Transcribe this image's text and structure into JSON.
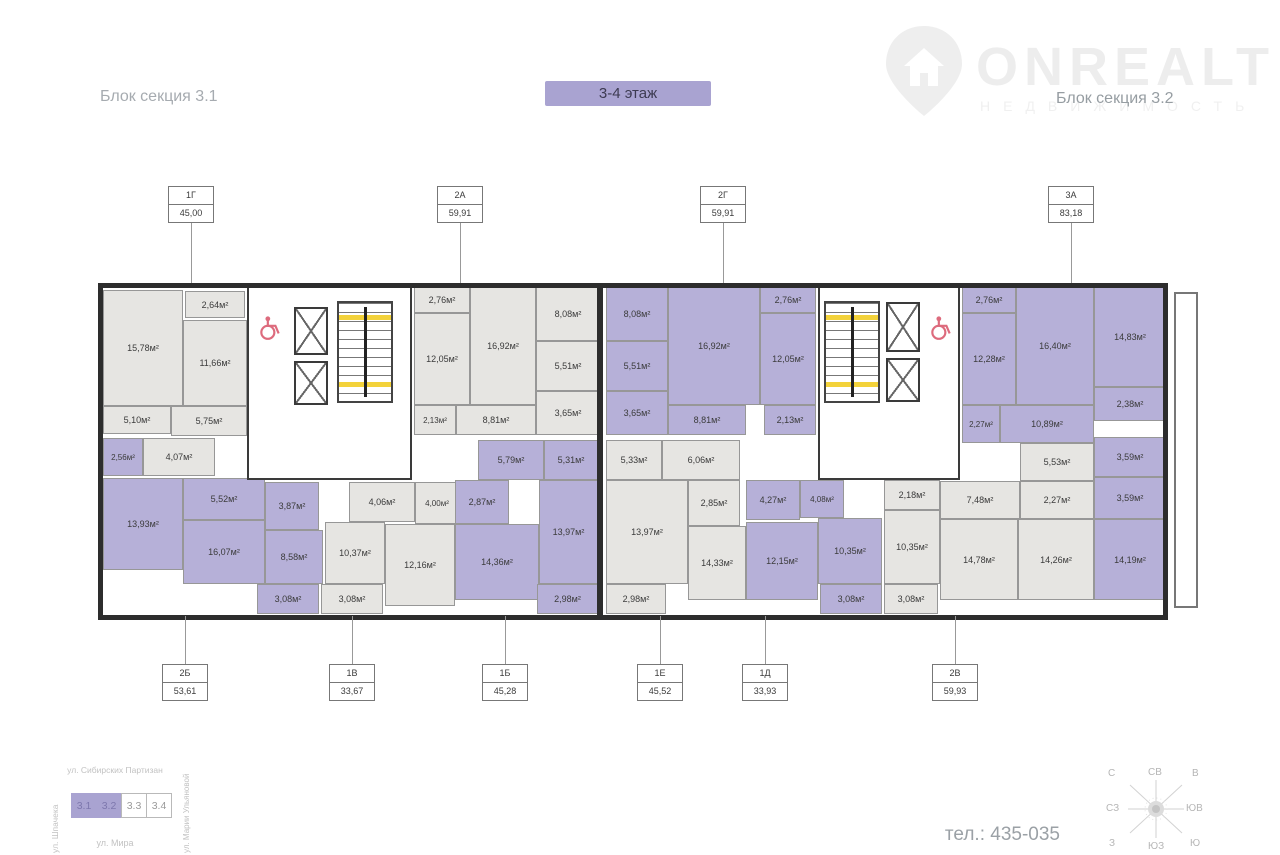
{
  "header": {
    "section_left": "Блок секция 3.1",
    "section_right": "Блок секция 3.2",
    "floor_badge": "3-4 этаж"
  },
  "logo": {
    "name": "ONREALT",
    "subtitle": "НЕДВИЖИМОСТЬ"
  },
  "colors": {
    "accent_purple": "#a9a3d1",
    "room_purple": "#b6b0d8",
    "room_gray": "#e6e5e2",
    "wall": "#2d2d2d",
    "stair_highlight": "#f3d23a",
    "wheelchair": "#dd6b7d"
  },
  "units": {
    "top": [
      {
        "code": "1Г",
        "area": "45,00",
        "x": 191
      },
      {
        "code": "2А",
        "area": "59,91",
        "x": 460
      },
      {
        "code": "2Г",
        "area": "59,91",
        "x": 723
      },
      {
        "code": "3А",
        "area": "83,18",
        "x": 1071
      }
    ],
    "bottom": [
      {
        "code": "2Б",
        "area": "53,61",
        "x": 185
      },
      {
        "code": "1В",
        "area": "33,67",
        "x": 352
      },
      {
        "code": "1Б",
        "area": "45,28",
        "x": 505
      },
      {
        "code": "1Е",
        "area": "45,52",
        "x": 660
      },
      {
        "code": "1Д",
        "area": "33,93",
        "x": 765
      },
      {
        "code": "2В",
        "area": "59,93",
        "x": 955
      }
    ]
  },
  "plan": {
    "rooms": [
      {
        "l": "15,78м²",
        "x": 103,
        "y": 290,
        "w": 80,
        "h": 116,
        "f": "g"
      },
      {
        "l": "2,64м²",
        "x": 185,
        "y": 291,
        "w": 60,
        "h": 27,
        "f": "g"
      },
      {
        "l": "11,66м²",
        "x": 183,
        "y": 320,
        "w": 64,
        "h": 86,
        "f": "g"
      },
      {
        "l": "5,10м²",
        "x": 103,
        "y": 406,
        "w": 68,
        "h": 28,
        "f": "g"
      },
      {
        "l": "5,75м²",
        "x": 171,
        "y": 406,
        "w": 76,
        "h": 30,
        "f": "g"
      },
      {
        "l": "4,07м²",
        "x": 143,
        "y": 438,
        "w": 72,
        "h": 38,
        "f": "g"
      },
      {
        "l": "2,56м²",
        "x": 103,
        "y": 438,
        "w": 40,
        "h": 38,
        "f": "p"
      },
      {
        "l": "13,93м²",
        "x": 103,
        "y": 478,
        "w": 80,
        "h": 92,
        "f": "p"
      },
      {
        "l": "5,52м²",
        "x": 183,
        "y": 478,
        "w": 82,
        "h": 42,
        "f": "p"
      },
      {
        "l": "3,87м²",
        "x": 265,
        "y": 482,
        "w": 54,
        "h": 48,
        "f": "p"
      },
      {
        "l": "16,07м²",
        "x": 183,
        "y": 520,
        "w": 82,
        "h": 64,
        "f": "p"
      },
      {
        "l": "8,58м²",
        "x": 265,
        "y": 530,
        "w": 58,
        "h": 54,
        "f": "p"
      },
      {
        "l": "3,08м²",
        "x": 257,
        "y": 584,
        "w": 62,
        "h": 30,
        "f": "p"
      },
      {
        "l": "3,08м²",
        "x": 321,
        "y": 584,
        "w": 62,
        "h": 30,
        "f": "g"
      },
      {
        "l": "4,06м²",
        "x": 349,
        "y": 482,
        "w": 66,
        "h": 40,
        "f": "g"
      },
      {
        "l": "4,00м²",
        "x": 415,
        "y": 482,
        "w": 44,
        "h": 42,
        "f": "g"
      },
      {
        "l": "10,37м²",
        "x": 325,
        "y": 522,
        "w": 60,
        "h": 62,
        "f": "g"
      },
      {
        "l": "12,16м²",
        "x": 385,
        "y": 524,
        "w": 70,
        "h": 82,
        "f": "g"
      },
      {
        "l": "2,76м²",
        "x": 414,
        "y": 287,
        "w": 56,
        "h": 26,
        "f": "g"
      },
      {
        "l": "12,05м²",
        "x": 414,
        "y": 313,
        "w": 56,
        "h": 92,
        "f": "g"
      },
      {
        "l": "16,92м²",
        "x": 470,
        "y": 287,
        "w": 66,
        "h": 118,
        "f": "g"
      },
      {
        "l": "8,08м²",
        "x": 536,
        "y": 287,
        "w": 64,
        "h": 54,
        "f": "g"
      },
      {
        "l": "5,51м²",
        "x": 536,
        "y": 341,
        "w": 64,
        "h": 50,
        "f": "g"
      },
      {
        "l": "3,65м²",
        "x": 536,
        "y": 391,
        "w": 64,
        "h": 44,
        "f": "g"
      },
      {
        "l": "2,13м²",
        "x": 414,
        "y": 405,
        "w": 42,
        "h": 30,
        "f": "g"
      },
      {
        "l": "8,81м²",
        "x": 456,
        "y": 405,
        "w": 80,
        "h": 30,
        "f": "g"
      },
      {
        "l": "5,79м²",
        "x": 478,
        "y": 440,
        "w": 66,
        "h": 40,
        "f": "p"
      },
      {
        "l": "5,31м²",
        "x": 544,
        "y": 440,
        "w": 54,
        "h": 40,
        "f": "p"
      },
      {
        "l": "2,87м²",
        "x": 455,
        "y": 480,
        "w": 54,
        "h": 44,
        "f": "p"
      },
      {
        "l": "14,36м²",
        "x": 455,
        "y": 524,
        "w": 84,
        "h": 76,
        "f": "p"
      },
      {
        "l": "13,97м²",
        "x": 539,
        "y": 480,
        "w": 59,
        "h": 104,
        "f": "p"
      },
      {
        "l": "2,98м²",
        "x": 537,
        "y": 584,
        "w": 61,
        "h": 30,
        "f": "p"
      },
      {
        "l": "8,08м²",
        "x": 606,
        "y": 287,
        "w": 62,
        "h": 54,
        "f": "p"
      },
      {
        "l": "5,51м²",
        "x": 606,
        "y": 341,
        "w": 62,
        "h": 50,
        "f": "p"
      },
      {
        "l": "3,65м²",
        "x": 606,
        "y": 391,
        "w": 62,
        "h": 44,
        "f": "p"
      },
      {
        "l": "16,92м²",
        "x": 668,
        "y": 287,
        "w": 92,
        "h": 118,
        "f": "p"
      },
      {
        "l": "2,76м²",
        "x": 760,
        "y": 287,
        "w": 56,
        "h": 26,
        "f": "p"
      },
      {
        "l": "12,05м²",
        "x": 760,
        "y": 313,
        "w": 56,
        "h": 92,
        "f": "p"
      },
      {
        "l": "8,81м²",
        "x": 668,
        "y": 405,
        "w": 78,
        "h": 30,
        "f": "p"
      },
      {
        "l": "2,13м²",
        "x": 764,
        "y": 405,
        "w": 52,
        "h": 30,
        "f": "p"
      },
      {
        "l": "5,33м²",
        "x": 606,
        "y": 440,
        "w": 56,
        "h": 40,
        "f": "g"
      },
      {
        "l": "6,06м²",
        "x": 662,
        "y": 440,
        "w": 78,
        "h": 40,
        "f": "g"
      },
      {
        "l": "2,85м²",
        "x": 688,
        "y": 480,
        "w": 52,
        "h": 46,
        "f": "g"
      },
      {
        "l": "13,97м²",
        "x": 606,
        "y": 480,
        "w": 82,
        "h": 104,
        "f": "g"
      },
      {
        "l": "14,33м²",
        "x": 688,
        "y": 526,
        "w": 58,
        "h": 74,
        "f": "g"
      },
      {
        "l": "2,98м²",
        "x": 606,
        "y": 584,
        "w": 60,
        "h": 30,
        "f": "g"
      },
      {
        "l": "4,27м²",
        "x": 746,
        "y": 480,
        "w": 54,
        "h": 40,
        "f": "p"
      },
      {
        "l": "4,08м²",
        "x": 800,
        "y": 480,
        "w": 44,
        "h": 38,
        "f": "p"
      },
      {
        "l": "10,35м²",
        "x": 818,
        "y": 518,
        "w": 64,
        "h": 66,
        "f": "p"
      },
      {
        "l": "12,15м²",
        "x": 746,
        "y": 522,
        "w": 72,
        "h": 78,
        "f": "p"
      },
      {
        "l": "3,08м²",
        "x": 820,
        "y": 584,
        "w": 62,
        "h": 30,
        "f": "p"
      },
      {
        "l": "2,18м²",
        "x": 884,
        "y": 480,
        "w": 56,
        "h": 30,
        "f": "g"
      },
      {
        "l": "10,35м²",
        "x": 884,
        "y": 510,
        "w": 56,
        "h": 74,
        "f": "g"
      },
      {
        "l": "3,08м²",
        "x": 884,
        "y": 584,
        "w": 54,
        "h": 30,
        "f": "g"
      },
      {
        "l": "7,48м²",
        "x": 940,
        "y": 481,
        "w": 80,
        "h": 38,
        "f": "g"
      },
      {
        "l": "5,53м²",
        "x": 1020,
        "y": 443,
        "w": 74,
        "h": 38,
        "f": "g"
      },
      {
        "l": "2,27м²",
        "x": 1020,
        "y": 481,
        "w": 74,
        "h": 38,
        "f": "g"
      },
      {
        "l": "14,78м²",
        "x": 940,
        "y": 519,
        "w": 78,
        "h": 81,
        "f": "g"
      },
      {
        "l": "14,26м²",
        "x": 1018,
        "y": 519,
        "w": 76,
        "h": 81,
        "f": "g"
      },
      {
        "l": "2,76м²",
        "x": 962,
        "y": 287,
        "w": 54,
        "h": 26,
        "f": "p"
      },
      {
        "l": "12,28м²",
        "x": 962,
        "y": 313,
        "w": 54,
        "h": 92,
        "f": "p"
      },
      {
        "l": "16,40м²",
        "x": 1016,
        "y": 287,
        "w": 78,
        "h": 118,
        "f": "p"
      },
      {
        "l": "14,83м²",
        "x": 1094,
        "y": 287,
        "w": 72,
        "h": 100,
        "f": "p"
      },
      {
        "l": "2,38м²",
        "x": 1094,
        "y": 387,
        "w": 72,
        "h": 34,
        "f": "p"
      },
      {
        "l": "2,27м²",
        "x": 962,
        "y": 405,
        "w": 38,
        "h": 38,
        "f": "p"
      },
      {
        "l": "10,89м²",
        "x": 1000,
        "y": 405,
        "w": 94,
        "h": 38,
        "f": "p"
      },
      {
        "l": "3,59м²",
        "x": 1094,
        "y": 437,
        "w": 72,
        "h": 40,
        "f": "p"
      },
      {
        "l": "3,59м²",
        "x": 1094,
        "y": 477,
        "w": 72,
        "h": 42,
        "f": "p"
      },
      {
        "l": "14,19м²",
        "x": 1094,
        "y": 519,
        "w": 72,
        "h": 81,
        "f": "p"
      }
    ]
  },
  "footer": {
    "phone": "тел.: 435-035",
    "streets": {
      "top": "ул. Сибирских Партизан",
      "left": "ул. Шпачека",
      "bottom": "ул. Мира",
      "right": "ул. Марии Ульяновой"
    },
    "blocks": [
      {
        "label": "3.1",
        "active": true
      },
      {
        "label": "3.2",
        "active": true
      },
      {
        "label": "3.3",
        "active": false
      },
      {
        "label": "3.4",
        "active": false
      }
    ]
  },
  "compass": {
    "labels": [
      {
        "t": "С",
        "x": 10,
        "y": 4
      },
      {
        "t": "СВ",
        "x": 50,
        "y": 3
      },
      {
        "t": "В",
        "x": 94,
        "y": 4
      },
      {
        "t": "СЗ",
        "x": 8,
        "y": 39
      },
      {
        "t": "ЮВ",
        "x": 88,
        "y": 39
      },
      {
        "t": "З",
        "x": 11,
        "y": 74
      },
      {
        "t": "ЮЗ",
        "x": 50,
        "y": 77
      },
      {
        "t": "Ю",
        "x": 92,
        "y": 74
      }
    ]
  }
}
